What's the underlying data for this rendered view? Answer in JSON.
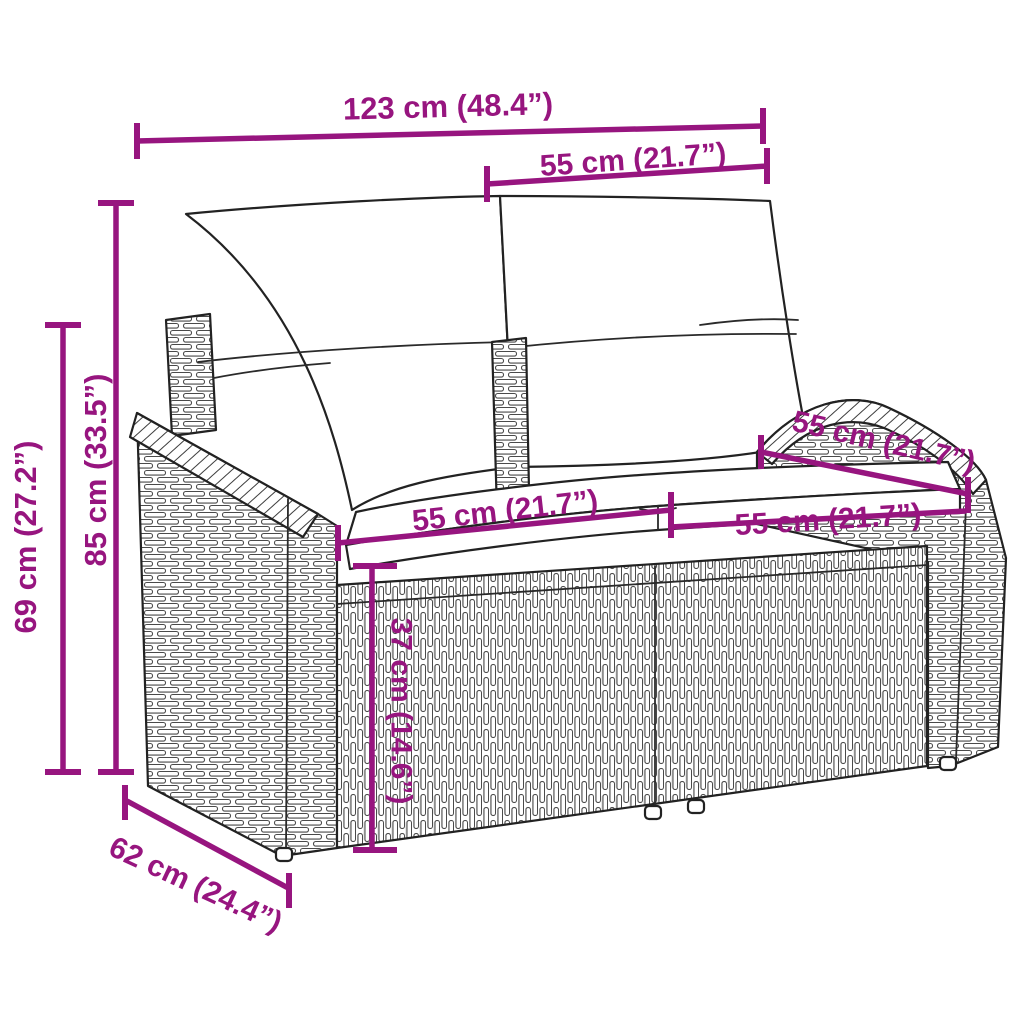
{
  "colors": {
    "dimension": "#97157f",
    "outline": "#222222",
    "weave": "#4a4a4a",
    "background": "#ffffff",
    "cushion": "#ffffff"
  },
  "annotations": [
    {
      "id": "total-width",
      "text": "123 cm (48.4”)"
    },
    {
      "id": "backrest-cushion-width",
      "text": "55 cm (21.7”)"
    },
    {
      "id": "total-height",
      "text": "85 cm (33.5”)"
    },
    {
      "id": "armrest-height",
      "text": "69 cm (27.2”)"
    },
    {
      "id": "seat-depth",
      "text": "55 cm (21.7”)"
    },
    {
      "id": "seat-width-left",
      "text": "55 cm (21.7”)"
    },
    {
      "id": "seat-width-right",
      "text": "55 cm (21.7”)"
    },
    {
      "id": "seat-height",
      "text": "37 cm (14.6”)"
    },
    {
      "id": "total-depth",
      "text": "62 cm (24.4”)"
    }
  ]
}
